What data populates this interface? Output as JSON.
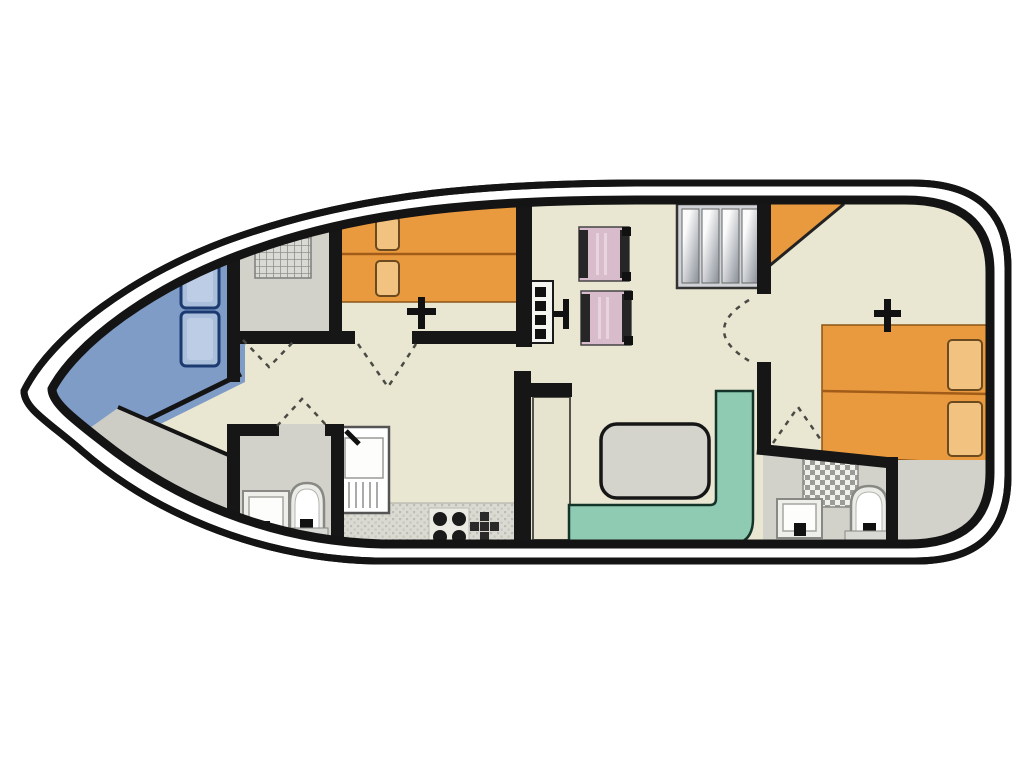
{
  "title": "houseboat-deck-floor-plan",
  "colors": {
    "background": "#ffffff",
    "hull_line": "#141414",
    "deck_floor": "#e9e7d2",
    "bow_blue": "#7f9cc7",
    "seat_blue": "#a9bfdc",
    "seat_blue_border": "#1b3a70",
    "room_gray": "#d2d2cb",
    "walkway_gray": "#cdcdc5",
    "bed_orange": "#ea9a3e",
    "bed_seam": "#a05c18",
    "pillow_orange": "#f2c380",
    "chair_pink": "#d9bccb",
    "chair_frame": "#222222",
    "bench_teal": "#8fcab3",
    "table_gray": "#d4d4cc",
    "counter_gray": "#d9d9d2",
    "cupboard_beige": "#e6e4cf",
    "fixture_light": "#ececE8",
    "stair_gray": "#cfd2d6",
    "wall_black": "#161616",
    "door_dash": "#4a4a44"
  },
  "icons": [
    "bow-seat-cushions",
    "shower-grid-icon",
    "twin-beds",
    "escape-hatch-arrow-icon",
    "helm-console-icon",
    "steering-wheel-icon",
    "pilot-chair",
    "companionway-stairs-icon",
    "corner-wardrobe",
    "double-bed",
    "dinette-table",
    "l-shaped-bench",
    "galley-sink-icon",
    "stove-burners-icon",
    "hob-plus-icon",
    "washbasin-icon",
    "toilet-icon",
    "door-swing-arc"
  ]
}
